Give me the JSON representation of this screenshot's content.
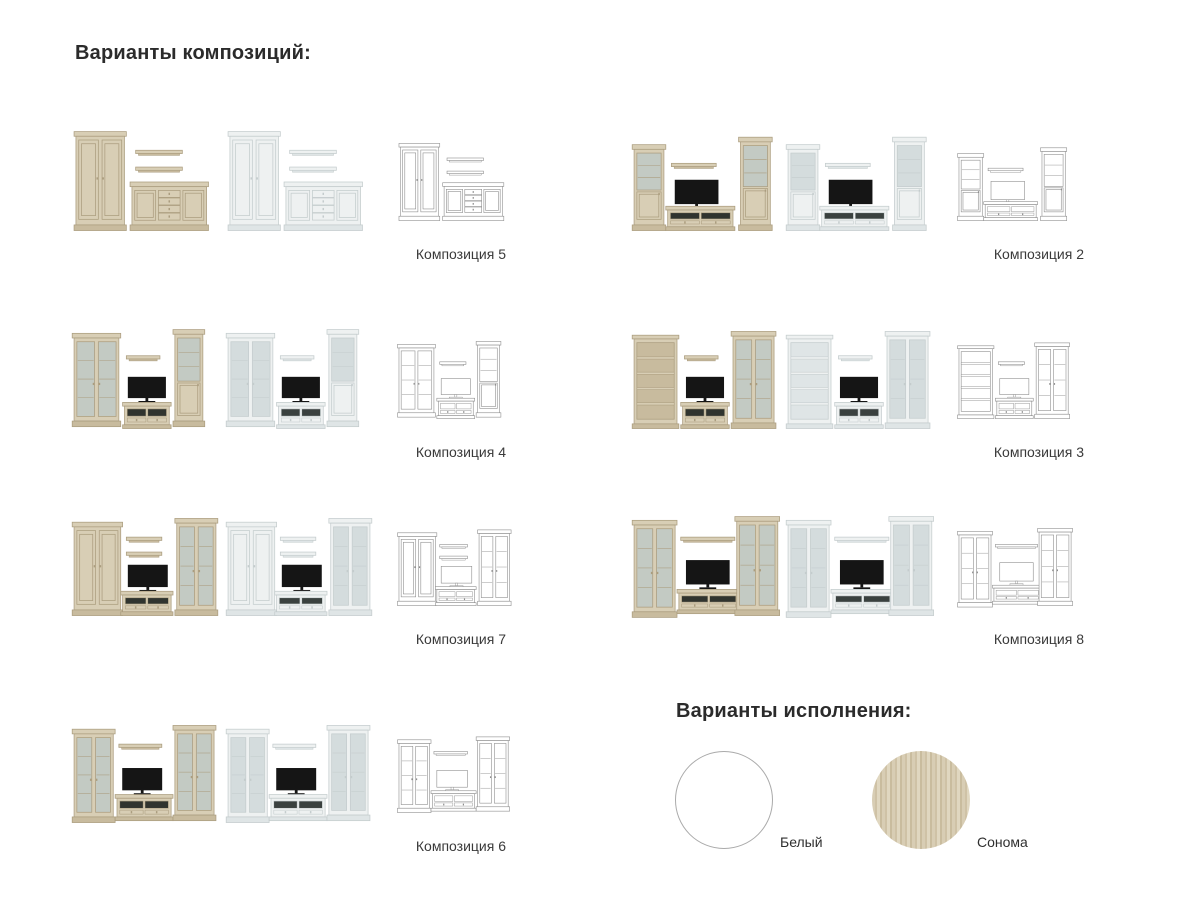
{
  "headings": {
    "compositions": "Варианты композиций:",
    "finishes": "Варианты исполнения:"
  },
  "compositions": [
    {
      "label": "Композиция 5",
      "parts": [
        [
          "ward",
          6,
          6,
          52,
          106
        ],
        [
          "shelf",
          70,
          26,
          50
        ],
        [
          "shelf",
          70,
          44,
          50
        ],
        [
          "side",
          66,
          60,
          80,
          52
        ]
      ]
    },
    {
      "label": "Композиция 2",
      "parts": [
        [
          "tower",
          4,
          20,
          32,
          92
        ],
        [
          "shelf",
          44,
          40,
          48
        ],
        [
          "tv",
          48,
          58,
          46
        ],
        [
          "stand",
          40,
          86,
          70,
          26,
          {
            "sec": "gog"
          }
        ],
        [
          "tower",
          118,
          12,
          32,
          100
        ]
      ]
    },
    {
      "label": "Композиция 4",
      "parts": [
        [
          "glass",
          4,
          10,
          48,
          100,
          {
            "solid": 0.32
          }
        ],
        [
          "shelf",
          60,
          34,
          36
        ],
        [
          "tv",
          62,
          57,
          40
        ],
        [
          "stand",
          58,
          84,
          48,
          28,
          {
            "sec": "2d"
          }
        ],
        [
          "tower",
          112,
          6,
          30,
          104
        ]
      ]
    },
    {
      "label": "Композиция 3",
      "parts": [
        [
          "book",
          4,
          12,
          46,
          100
        ],
        [
          "shelf",
          58,
          34,
          36
        ],
        [
          "tv",
          60,
          57,
          40
        ],
        [
          "stand",
          56,
          84,
          48,
          28,
          {
            "sec": "2d"
          }
        ],
        [
          "glass",
          110,
          8,
          44,
          104
        ]
      ]
    },
    {
      "label": "Композиция 7",
      "parts": [
        [
          "ward",
          4,
          12,
          50,
          100
        ],
        [
          "shelf",
          60,
          28,
          38
        ],
        [
          "shelf",
          60,
          44,
          38
        ],
        [
          "tv",
          62,
          58,
          42
        ],
        [
          "stand",
          56,
          86,
          52,
          26,
          {
            "sec": "2d"
          }
        ],
        [
          "glass",
          114,
          8,
          42,
          104
        ]
      ]
    },
    {
      "label": "Композиция 8",
      "parts": [
        [
          "glass",
          4,
          10,
          44,
          104,
          {
            "dr": 2
          }
        ],
        [
          "shelf",
          54,
          28,
          58
        ],
        [
          "tv",
          60,
          53,
          46
        ],
        [
          "stand",
          52,
          84,
          64,
          26,
          {
            "sec": "gog"
          }
        ],
        [
          "glass",
          114,
          6,
          44,
          106,
          {
            "dr": 2
          }
        ]
      ]
    },
    {
      "label": "Композиция 6",
      "parts": [
        [
          "glass",
          4,
          12,
          42,
          100
        ],
        [
          "shelf",
          52,
          28,
          46
        ],
        [
          "tv",
          56,
          54,
          42
        ],
        [
          "stand",
          50,
          82,
          58,
          28,
          {
            "sec": "gog"
          }
        ],
        [
          "glass",
          112,
          8,
          42,
          102
        ]
      ]
    }
  ],
  "render_variants": [
    "sonoma",
    "white",
    "wireframe"
  ],
  "render_palettes": {
    "sonoma": {
      "body": "#d8ceb5",
      "shade": "#c8bb9e",
      "stroke": "#ab9d7f",
      "glass": "#c3cac3",
      "dark": "#30342f",
      "tv": "#151515"
    },
    "white": {
      "body": "#eef1f1",
      "shade": "#dfe5e6",
      "stroke": "#c4cccd",
      "glass": "#d4dcdd",
      "dark": "#3a413f",
      "tv": "#151515"
    },
    "wireframe": {
      "body": "#ffffff",
      "shade": "#ffffff",
      "stroke": "#8c8c8c",
      "glass": "#ffffff",
      "dark": "#ffffff",
      "tv": "#ffffff"
    }
  },
  "finishes": [
    {
      "label": "Белый",
      "color": "#ffffff",
      "border": "#aaaaaa"
    },
    {
      "label": "Сонома",
      "color": "#d6cbb1",
      "grain": [
        "#d8cdb4",
        "#cfc2a6",
        "#e0d7c0",
        "#c9bc9e"
      ]
    }
  ]
}
